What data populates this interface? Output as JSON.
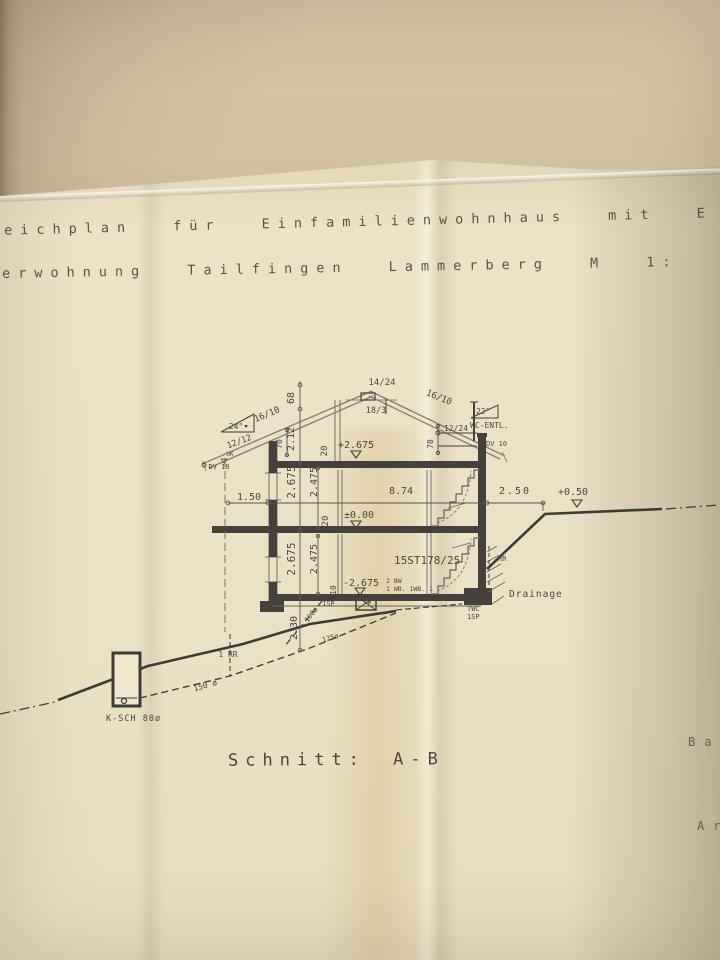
{
  "title": {
    "line1": "eichplan für Einfamilienwohnhaus mit E",
    "line2": "erwohnung Tailfingen Lammerberg M 1:"
  },
  "captions": {
    "section": "Schnitt:  A-B",
    "right_truncated_top": "Bau",
    "right_truncated_bottom": "Ar"
  },
  "labels": {
    "ridge_beam": "14/24",
    "rafter_left": "16/10",
    "ridge_board": "18/3",
    "rafter_right": "16/10",
    "roof_angle_left": "24°",
    "roof_pitch_left": "12/12",
    "roof_angle_right": "22°",
    "vent_pipe": "WC-ENTL.",
    "purlin_right": "12/24",
    "dv10_right": "DV 10",
    "dim_70_right": "70",
    "dim_68": "68",
    "dim_212": "2.12",
    "dim_70_left": "70",
    "uk_left": "UK",
    "dv10_left": "DV 10",
    "level_upper": "+2.675",
    "slab_20_upper": "20",
    "storey_upper": "2.675",
    "clear_upper": "2.475",
    "dim_150": "1.50",
    "dim_874": "8.74",
    "dim_250": "2.50",
    "level_terrain": "+0.50",
    "level_zero": "±0.00",
    "slab_20_lower": "20",
    "storey_lower": "2.675",
    "clear_lower": "2.475",
    "stair_note": "15ST178/25",
    "level_basement": "-2.675",
    "slab_10": "10",
    "note_bw": "2 BW",
    "note_wb": "1 WB. 1WB. 1",
    "note_sp_left": "1SP",
    "note_tw": "TW",
    "note_twc": "TWC",
    "note_sp_right": "1SP",
    "rr_right": "RR",
    "drainage": "Drainage",
    "pipe_100": "100ø",
    "pipe_125": "125ø",
    "dim_230": "2.30",
    "rr_left": "1 RR",
    "pipe_150": "150 ø",
    "shaft": "K-SCH 80ø"
  },
  "colors": {
    "paper": "#ebe1c6",
    "ink": "#45413a",
    "pencil": "#8d8072",
    "label": "#4e463c"
  }
}
